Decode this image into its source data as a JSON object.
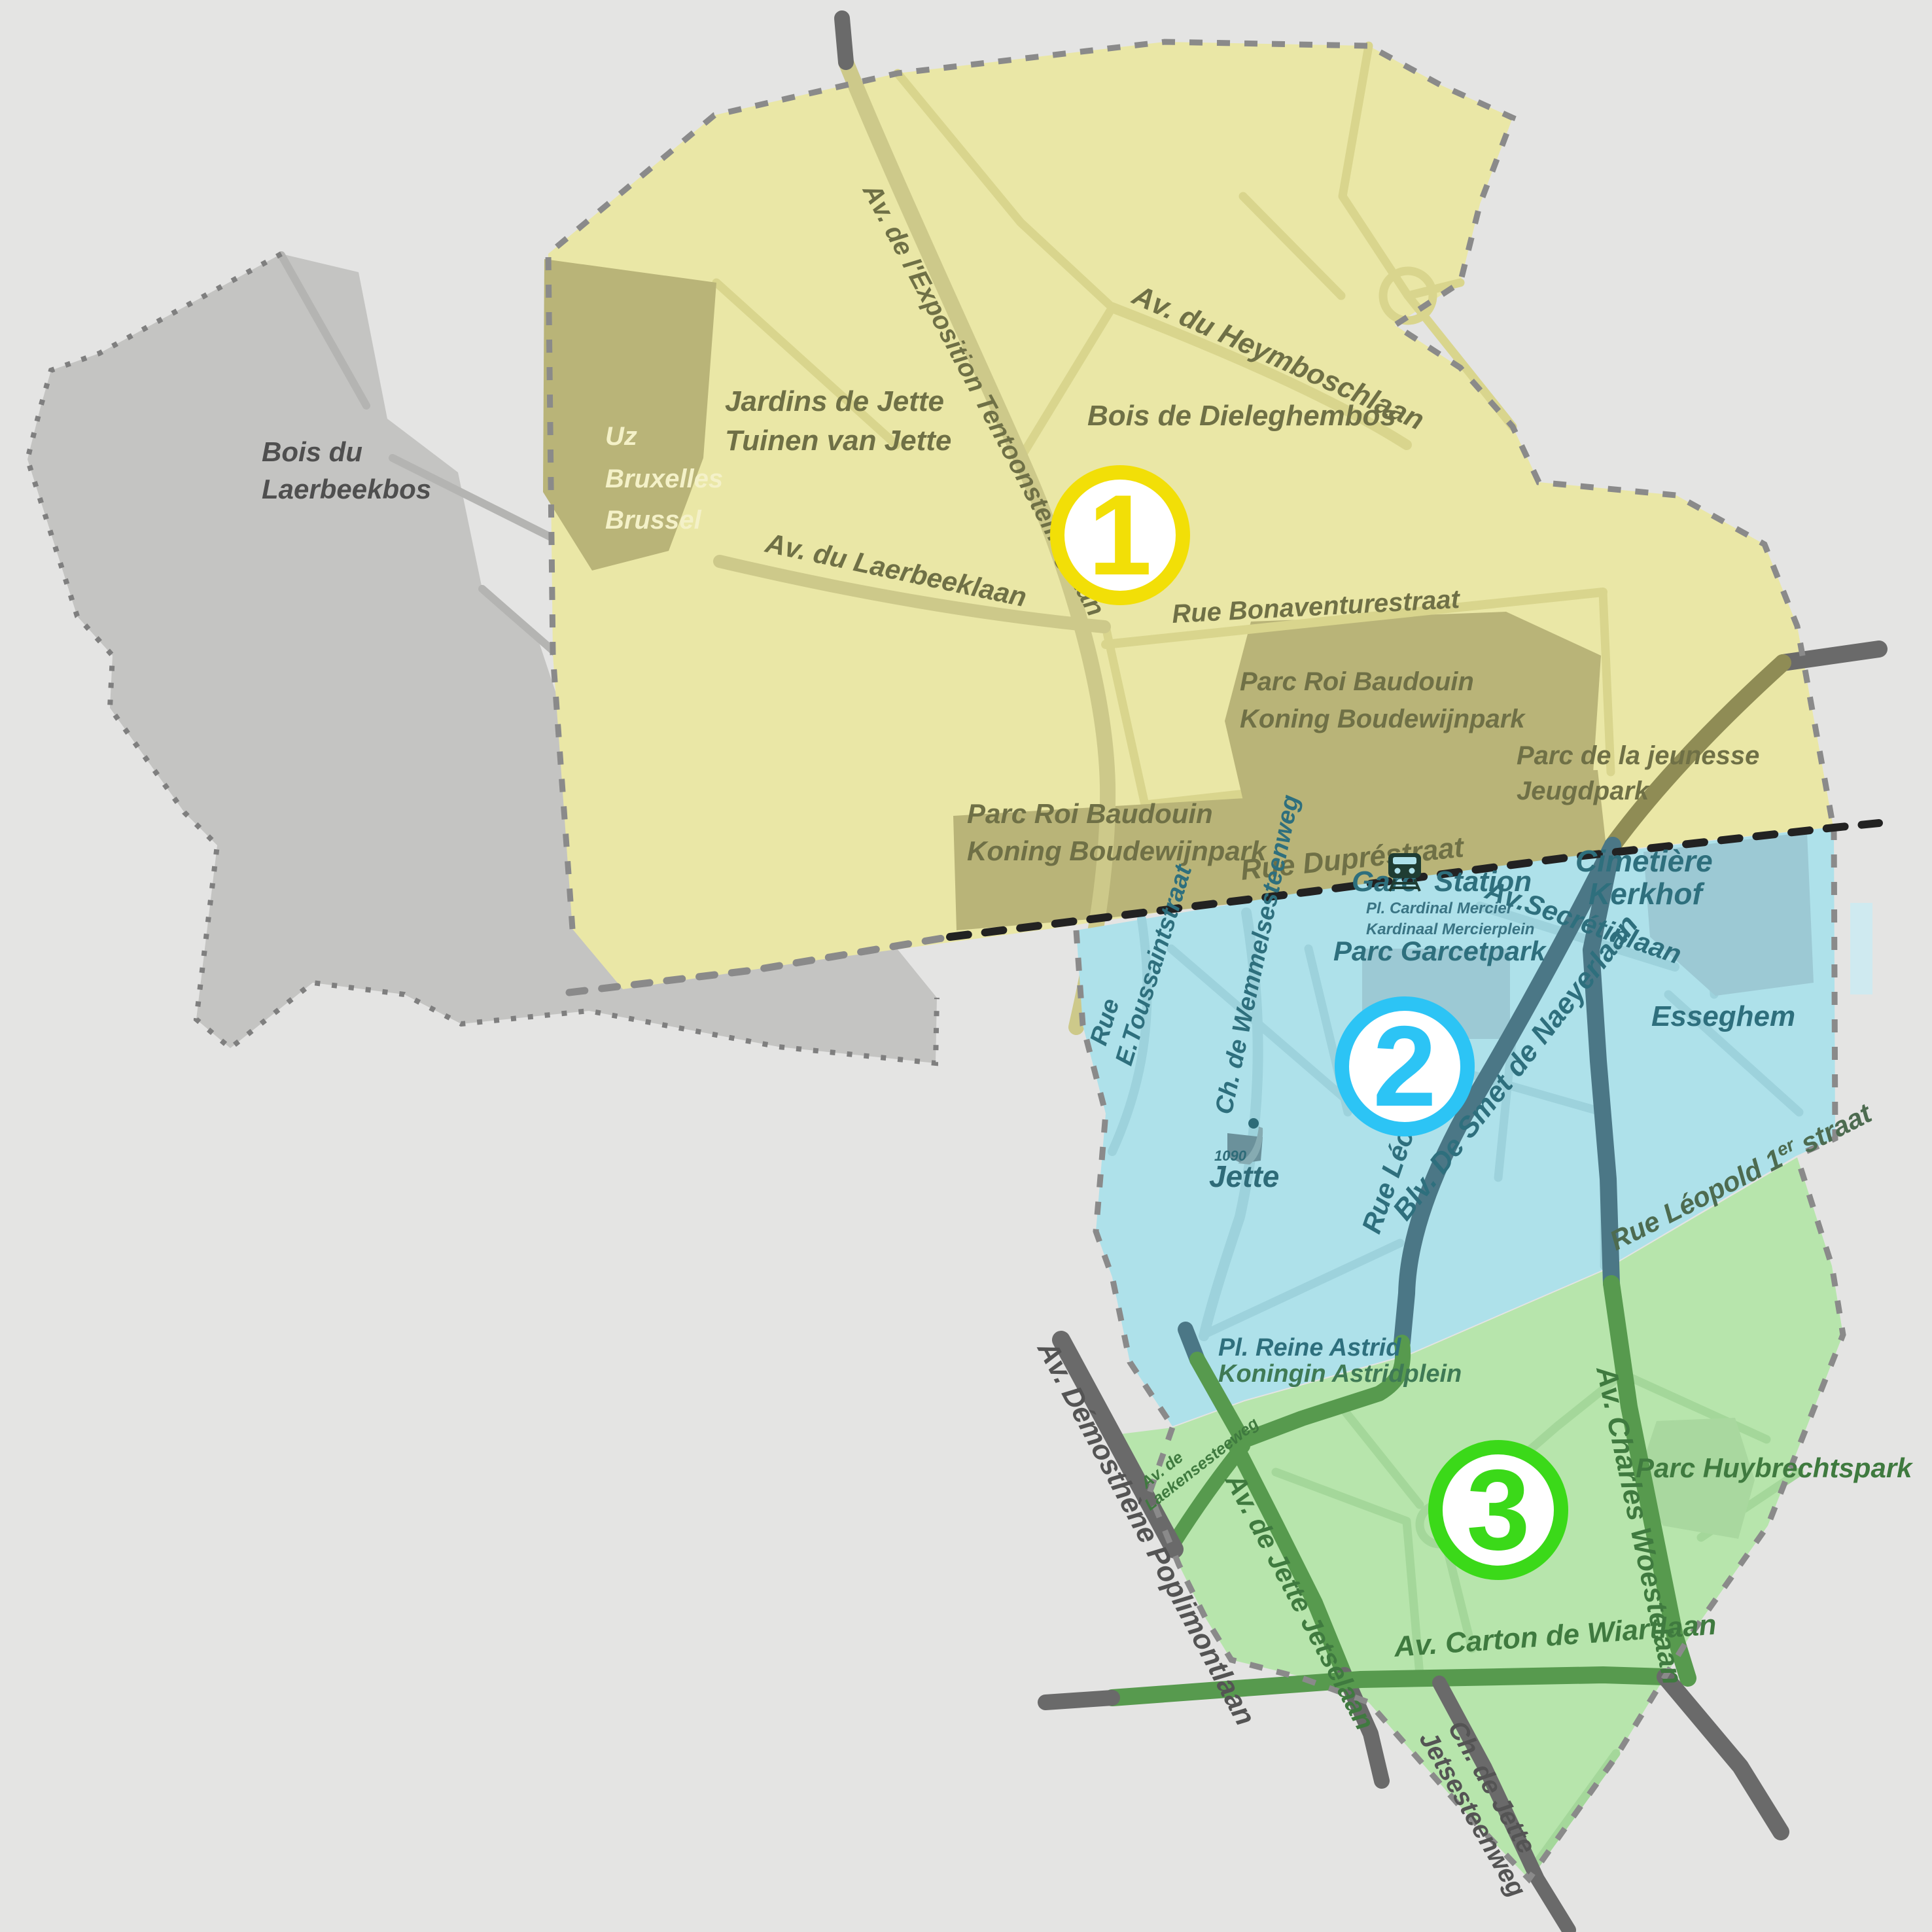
{
  "map": {
    "title": "Jette municipality zones map",
    "zone_markers": [
      {
        "number": "1",
        "color": "#f2df07",
        "zone_fill": "#eae7a6"
      },
      {
        "number": "2",
        "color": "#2cc4f5",
        "zone_fill": "#aee1ea"
      },
      {
        "number": "3",
        "color": "#3bd919",
        "zone_fill": "#b7e5ac"
      }
    ],
    "colors": {
      "background": "#e4e4e3",
      "out_of_zone_gray": "#c4c4c2",
      "olive_parks": "#b9b478",
      "blue_parks": "#9cc9d4",
      "green_park": "#a9d89f",
      "major_road_dark_gray": "#6a6a6a",
      "major_road_olive": "#8f8c55",
      "major_road_teal": "#4b7786",
      "major_road_green": "#579a4e",
      "boundary_dash_gray": "#8a8a8a",
      "boundary_dash_black": "#222222"
    },
    "station": {
      "fr": "Gare",
      "nl": "Station"
    },
    "logo": {
      "postcode": "1090",
      "name": "Jette"
    },
    "labels": {
      "laerbeekbos": [
        "Bois du",
        "Laerbeekbos"
      ],
      "uz": [
        "Uz",
        "Bruxelles",
        "Brussel"
      ],
      "jardins": [
        "Jardins de Jette",
        "Tuinen van Jette"
      ],
      "exposition": "Av. de l'Exposition Tentoonstellinglaan",
      "heymbosch": "Av. du Heymboschlaan",
      "dieleghem": "Bois de Dieleghembos",
      "laerbeeklaan": "Av. du Laerbeeklaan",
      "bonaventure": "Rue Bonaventurestraat",
      "parc_baudouin_1": [
        "Parc Roi Baudouin",
        "Koning Boudewijnpark"
      ],
      "parc_baudouin_2": [
        "Parc Roi Baudouin",
        "Koning Boudewijnpark"
      ],
      "jeunesse": [
        "Parc de la jeunesse",
        "Jeugdpark"
      ],
      "dupre": "Rue Dupréstraat",
      "mercier": [
        "Pl. Cardinal Mercier",
        "Kardinaal Mercierplein"
      ],
      "secretin": "Av.Secrétinlaan",
      "cimetiere": [
        "Cimetière",
        "Kerkhof"
      ],
      "garcet": "Parc Garcetpark",
      "esseghem": "Esseghem",
      "toussaint": [
        "Rue",
        "E.Toussaintstraat"
      ],
      "wemmel": "Ch. de Wemmelsesteenweg",
      "rue_leo": "Rue Léo",
      "smet": "Blv. De Smet de Naeyerlaan",
      "leopold": {
        "p1": "Rue Léopold 1",
        "sup": "er",
        "p2": " straat"
      },
      "astrid": [
        "Pl. Reine Astrid",
        "Koningin Astridplein"
      ],
      "poplimont": "Av. Démosthène Poplimontlaan",
      "laeken": [
        "Av. de",
        "Laekensesteeweg"
      ],
      "jette_av": "Av. de Jette Jetselaan",
      "woeste": "Av. Charles Woestelaan",
      "huybrechts": "Parc Huybrechtspark",
      "wiart": "Av. Carton de Wiartlaan",
      "chjette": [
        "Ch. de Jette",
        "Jetsesteenweg"
      ]
    }
  }
}
